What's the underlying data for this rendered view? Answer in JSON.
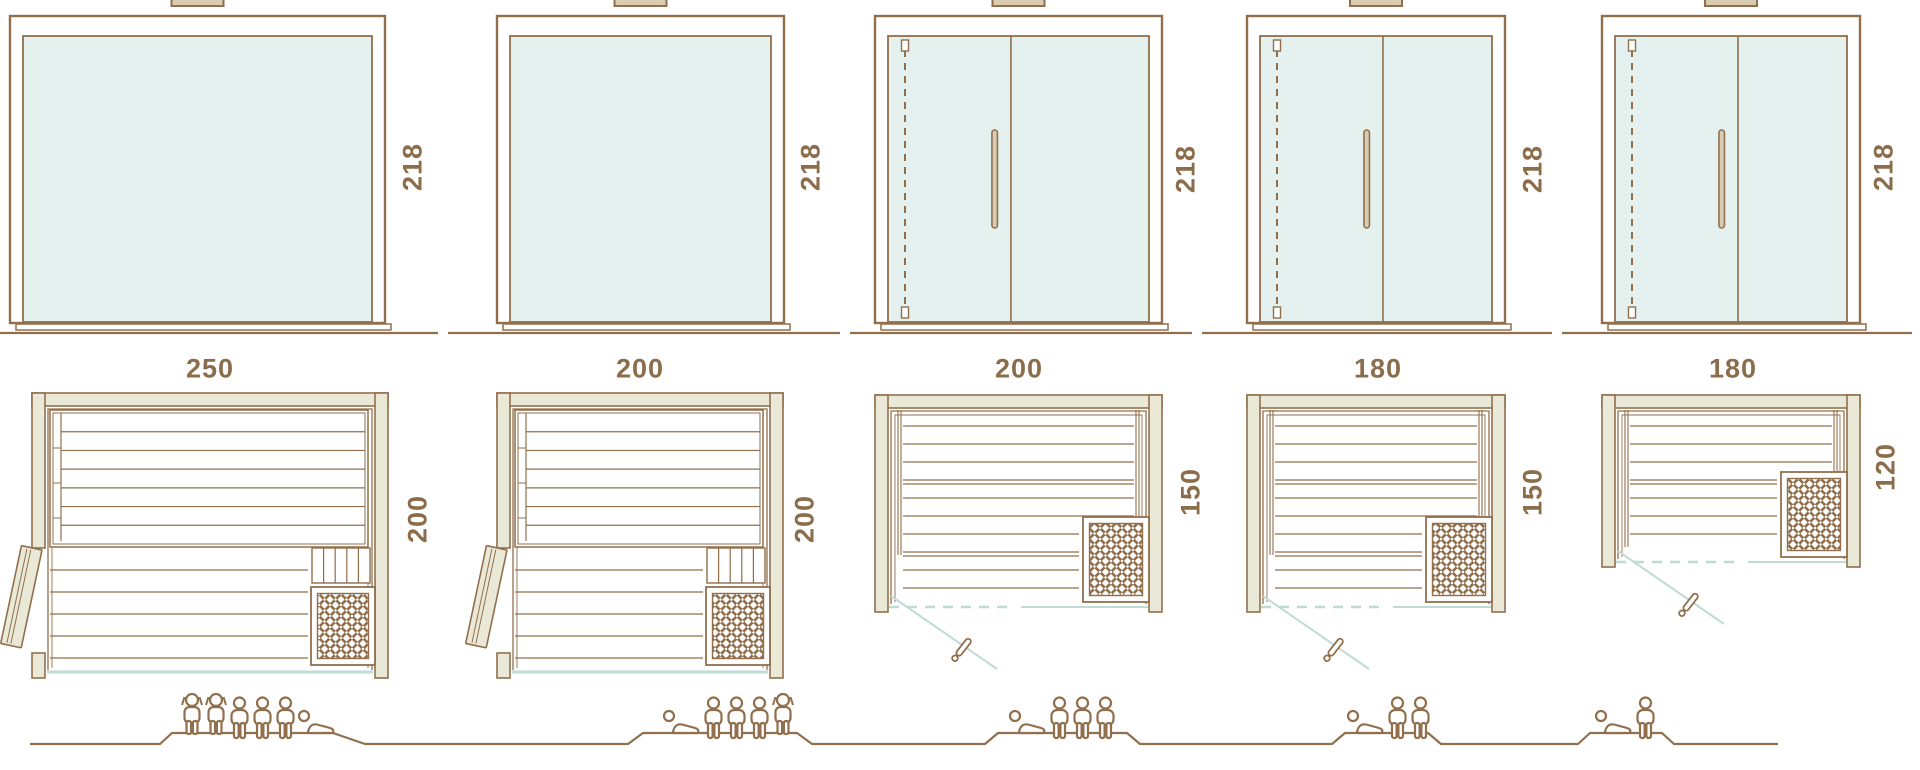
{
  "diagram_title": "sauna-cabin-size-variants",
  "colors": {
    "line": "#916F4C",
    "text": "#8C6D4B",
    "glass": "#E4F1EE",
    "wood": "#EAE9D8",
    "teal": "#BEDBD6",
    "tab": "#D8CCB2",
    "background": "#FFFFFF"
  },
  "models": [
    {
      "front_width_label": "250",
      "height_label": "218",
      "depth_label": "200",
      "door_type": "side-wood-door",
      "capacity": {
        "standing": 2,
        "sitting": 3,
        "lying": 1
      },
      "capacity_icons": [
        "standing-person",
        "sitting-person",
        "lying-person"
      ]
    },
    {
      "front_width_label": "200",
      "height_label": "218",
      "depth_label": "200",
      "door_type": "side-wood-door",
      "capacity": {
        "standing": 1,
        "sitting": 3,
        "lying": 1
      },
      "capacity_icons": [
        "lying-person",
        "sitting-person",
        "standing-person"
      ]
    },
    {
      "front_width_label": "200",
      "height_label": "218",
      "depth_label": "150",
      "door_type": "front-glass-door",
      "capacity": {
        "standing": 0,
        "sitting": 3,
        "lying": 1
      },
      "capacity_icons": [
        "lying-person",
        "sitting-person"
      ]
    },
    {
      "front_width_label": "180",
      "height_label": "218",
      "depth_label": "150",
      "door_type": "front-glass-door",
      "capacity": {
        "standing": 0,
        "sitting": 2,
        "lying": 1
      },
      "capacity_icons": [
        "lying-person",
        "sitting-person"
      ]
    },
    {
      "front_width_label": "180",
      "height_label": "218",
      "depth_label": "120",
      "door_type": "front-glass-door",
      "capacity": {
        "standing": 0,
        "sitting": 1,
        "lying": 1
      },
      "capacity_icons": [
        "lying-person",
        "sitting-person"
      ]
    }
  ]
}
